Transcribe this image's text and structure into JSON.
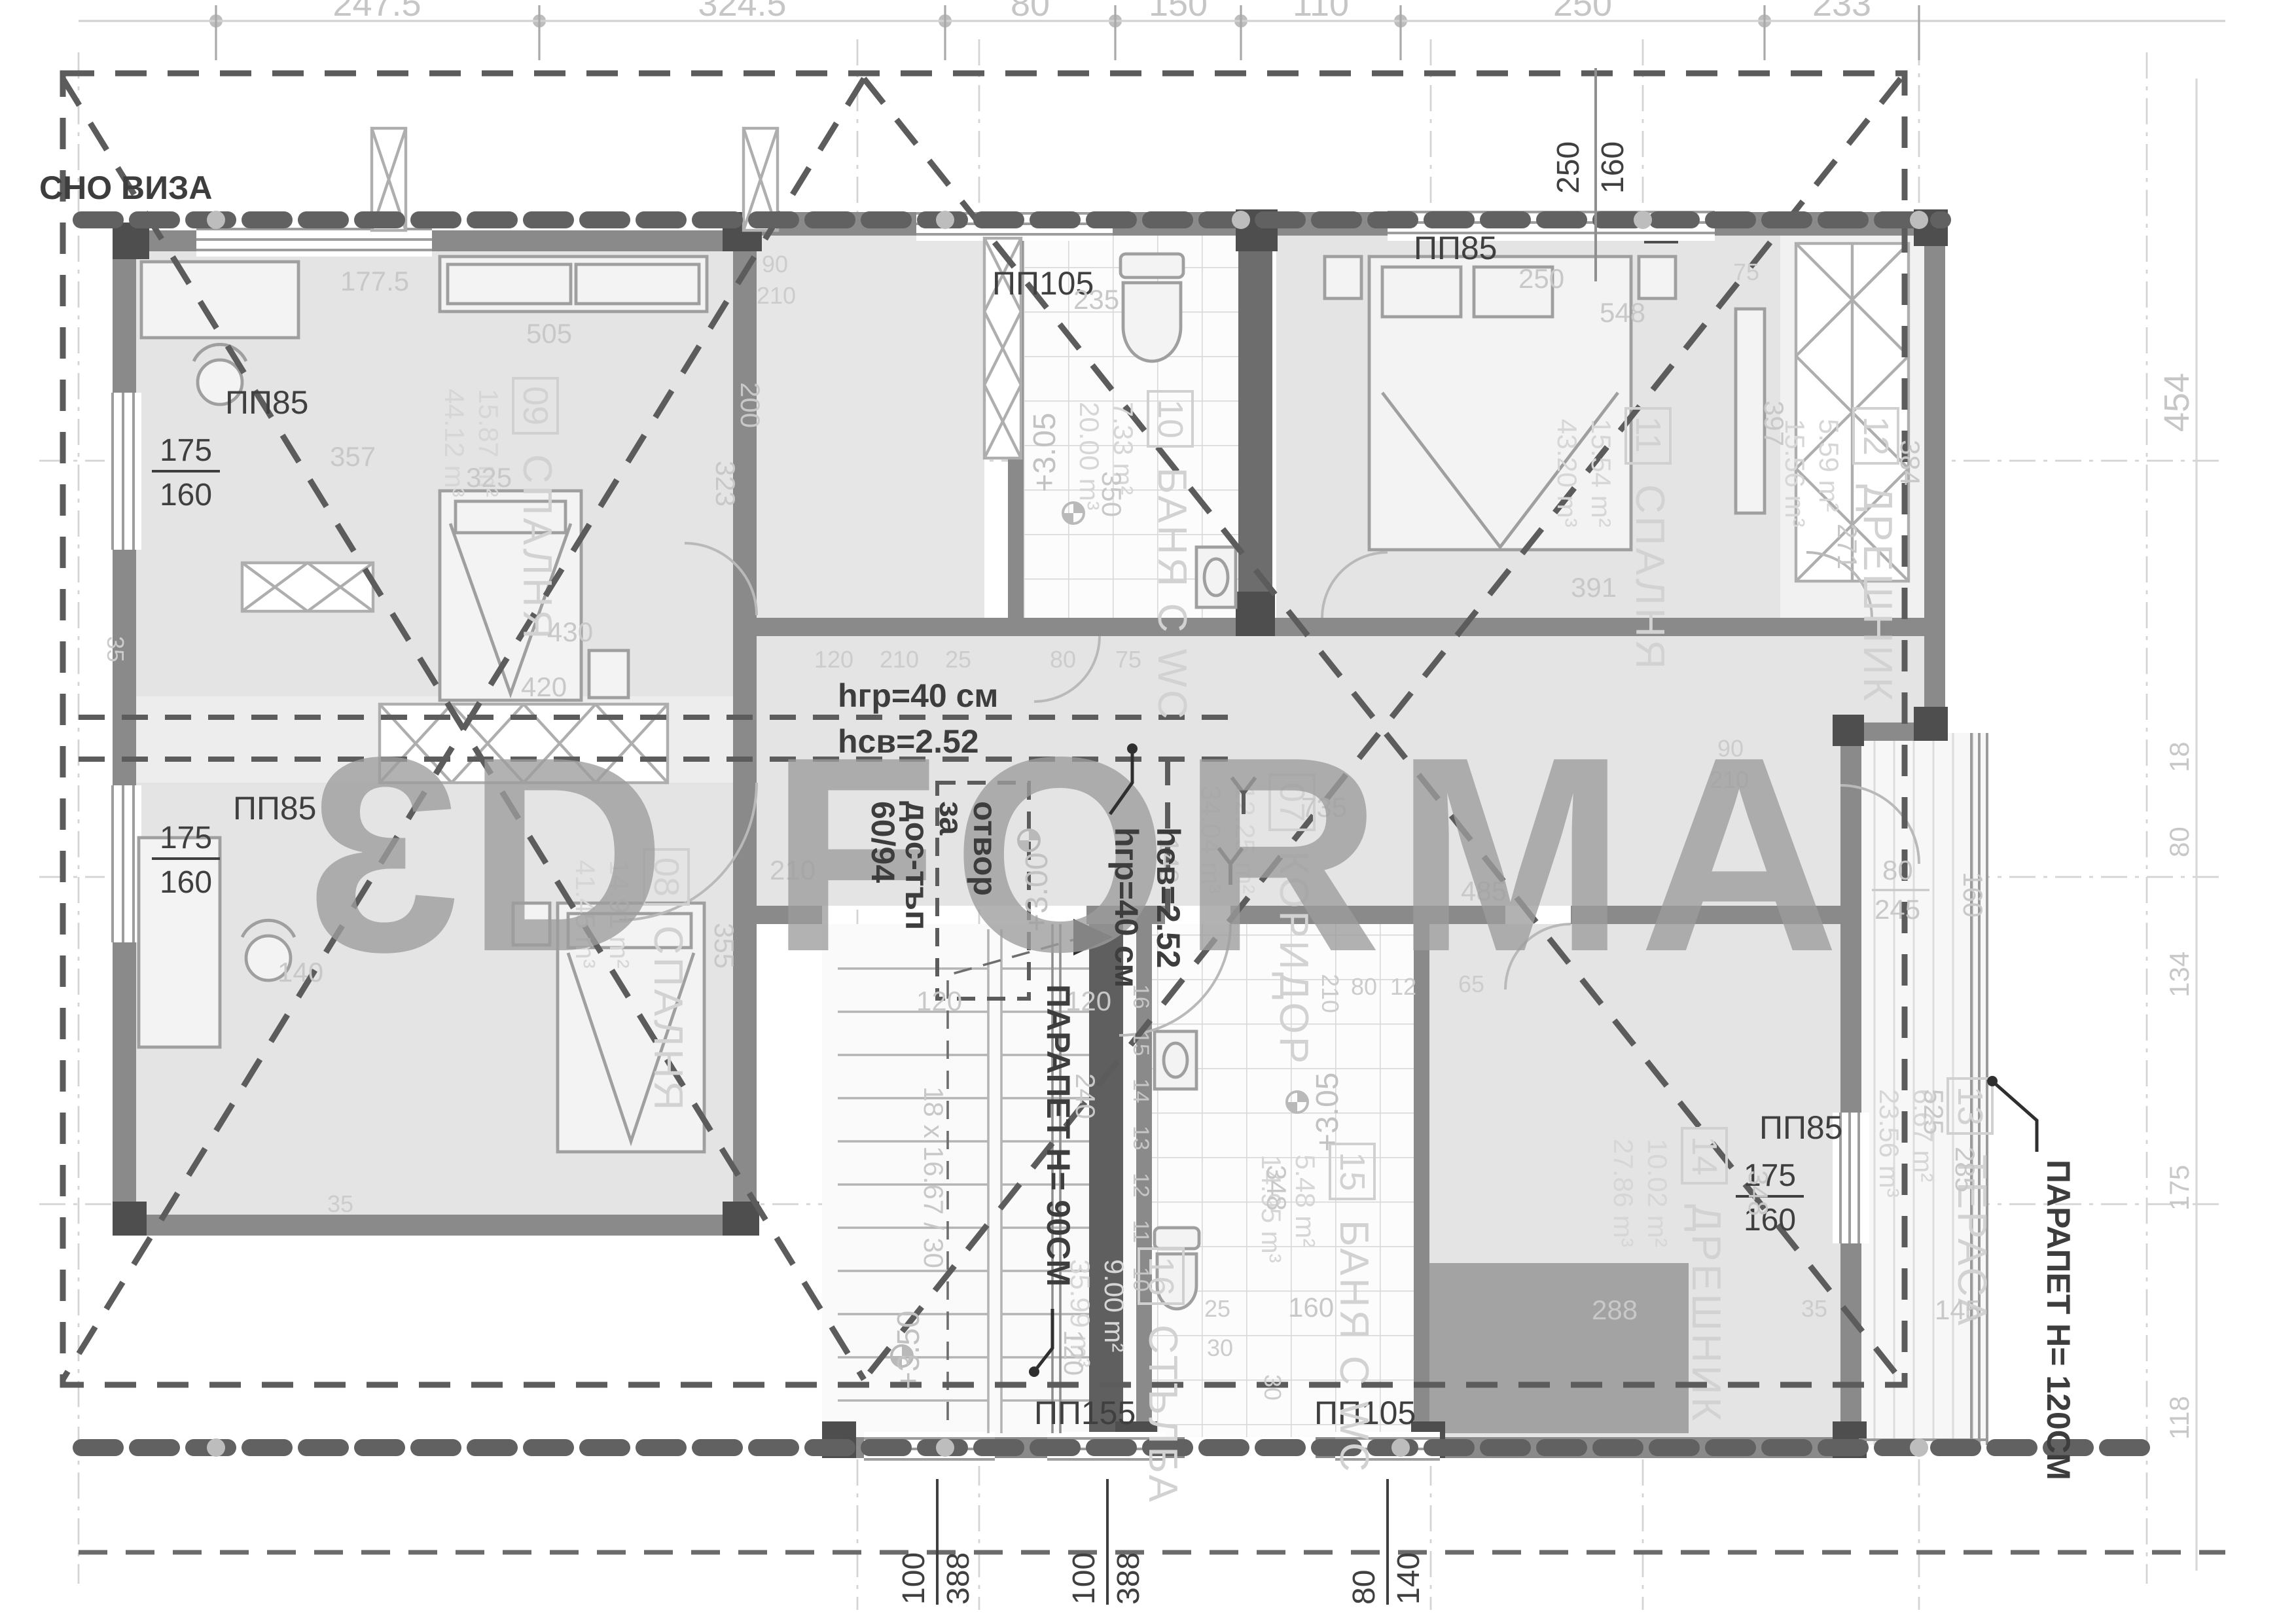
{
  "watermark": {
    "prefix": "3",
    "rest": "D FORMA",
    "full": "3D FORMA"
  },
  "notes": {
    "visa": "СНО ВИЗА",
    "hgr_line1": "hгр=40 см",
    "hgr_line2": "hсв=2.52",
    "hgr_vert1": "hгр=40 см",
    "hgr_vert2": "hсв=2.52",
    "opening_l1": "отвор",
    "opening_l2": "за",
    "opening_l3": "дос-тъп",
    "opening_l4": "60/94",
    "parapet_stair": "ПАРАПЕТ H= 90СМ",
    "parapet_terrace": "ПАРАПЕТ H= 120СМ"
  },
  "stair": {
    "formula": "18 х 16.67 / 30",
    "steps": [
      "16",
      "15",
      "14",
      "13",
      "12",
      "11",
      "10"
    ]
  },
  "levels": {
    "bath10": "+3.05",
    "hall": "+3.00",
    "bath15": "+3.05",
    "stair": "+3.50"
  },
  "dims_top": [
    "247.5",
    "324.5",
    "80",
    "150",
    "110",
    "250",
    "233"
  ],
  "dims_right": [
    "454",
    "18",
    "80",
    "134",
    "175",
    "118"
  ],
  "windows": {
    "tr": {
      "w": "250",
      "h": "160"
    },
    "l1": {
      "w": "175",
      "h": "160"
    },
    "l2": {
      "w": "175",
      "h": "160"
    },
    "r1": {
      "w": "175",
      "h": "160"
    },
    "b1": {
      "w": "100",
      "h": "388"
    },
    "b2": {
      "w": "100",
      "h": "388"
    },
    "b3": {
      "w": "80",
      "h": "140"
    }
  },
  "tags": {
    "top_left": "ПП85",
    "left": "ПП85",
    "top_bath": "ПП105",
    "top_right": "ПП85",
    "right": "ПП85",
    "stair": "ПП155",
    "bottom_bath": "ПП105"
  },
  "rooms": [
    {
      "num": "07",
      "name": "КОРИДОР",
      "area": "12.25 m²",
      "volume": "34.04 m³"
    },
    {
      "num": "08",
      "name": "СПАЛНЯ",
      "area": "14.91 m²",
      "volume": "41.45 m³"
    },
    {
      "num": "09",
      "name": "СПАЛНЯ",
      "area": "15.87 m²",
      "volume": "44.12 m³"
    },
    {
      "num": "10",
      "name": "БАНЯ С WC",
      "area": "7.33 m²",
      "volume": "20.00 m³"
    },
    {
      "num": "11",
      "name": "СПАЛНЯ",
      "area": "15.54 m²",
      "volume": "43.20 m³"
    },
    {
      "num": "12",
      "name": "ДРЕШНИК",
      "area": "5.59 m²",
      "volume": "15.56 m³"
    },
    {
      "num": "13",
      "name": "ТЕРАСА",
      "area": "6.67 m²",
      "volume": "23.56 m³"
    },
    {
      "num": "14",
      "name": "ДРЕШНИК",
      "area": "10.02 m²",
      "volume": "27.86 m³"
    },
    {
      "num": "15",
      "name": "БАНЯ С WC",
      "area": "5.48 m²",
      "volume": "14.95 m³"
    },
    {
      "num": "16",
      "name": "СТЪЛБА",
      "area": "9.00 m²",
      "volume": "35.99 m³"
    }
  ],
  "gdims": {
    "r09_top": "177.5",
    "r09_dresser": "505",
    "r09_left": "357",
    "r09_mid": "325",
    "r09_w": "323",
    "r09_h": "200",
    "r09_bed": "430",
    "r08_closet": "420",
    "r08_w": "355",
    "r08_door": "210",
    "r08_left": "140",
    "wall35_left": "35",
    "wall35_bl": "35",
    "bath10_w": "235",
    "bath10_h": "350",
    "hall_door_w": "90",
    "hall_door_h": "210",
    "row_120": "120",
    "row_210": "210",
    "row_25": "25",
    "row_75": "75",
    "row_80": "80",
    "r11_250": "250",
    "r11_548": "548",
    "r11_75": "75",
    "r11_391": "391",
    "r11_397": "397",
    "w12_384": "384",
    "w12_271": "271",
    "cor_735": "735",
    "cor_485": "485",
    "cor_65": "65",
    "cor_210": "210",
    "cor_80": "80",
    "cor_12": "12",
    "cor_140": "140",
    "door2_w": "90",
    "door2_h": "210",
    "ter_80": "80",
    "ter_245": "245",
    "ter_160": "160",
    "st_120a": "120",
    "st_120b": "120",
    "st_240": "240",
    "st_120c": "120",
    "b15_348": "348",
    "b15_25": "25",
    "b15_160": "160",
    "b15_30a": "30",
    "b15_30b": "30",
    "r14_288": "288",
    "r14_348": "348",
    "r14_35": "35",
    "t13_525": "525",
    "t13_285": "285",
    "t13_145": "145"
  }
}
